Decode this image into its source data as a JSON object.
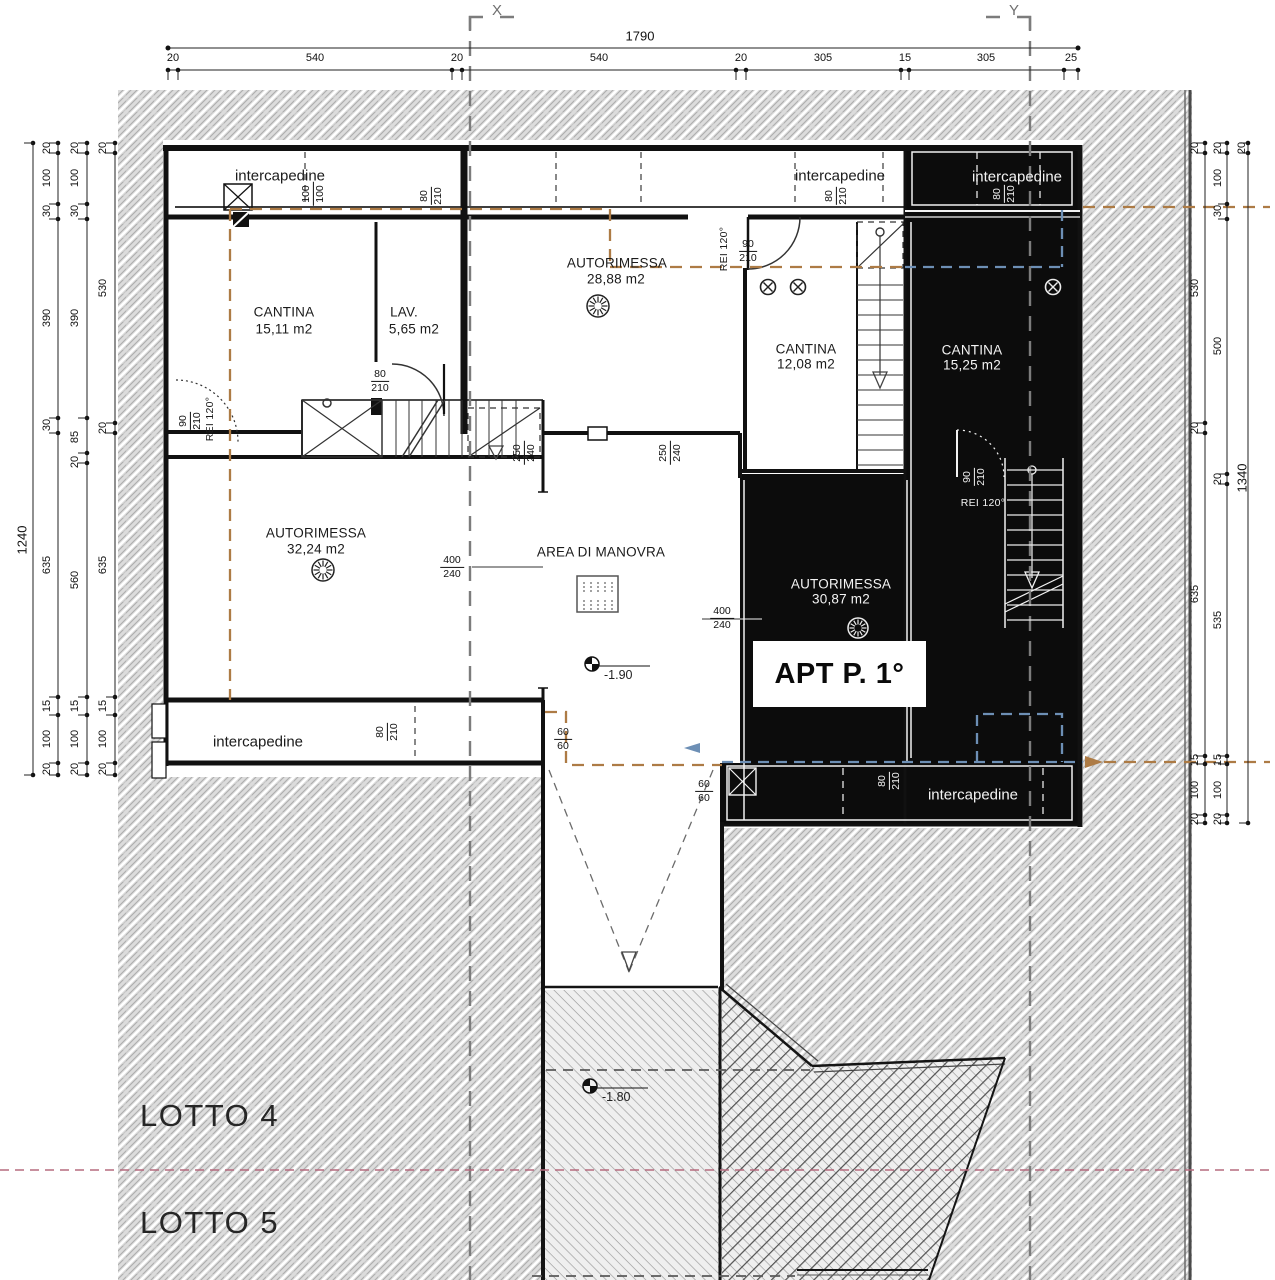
{
  "grid_markers": {
    "x": "X",
    "y": "Y"
  },
  "dimensions": {
    "top": {
      "total": "1790",
      "segments": [
        "20",
        "540",
        "20",
        "540",
        "20",
        "305",
        "15",
        "305",
        "25"
      ]
    },
    "left": {
      "total": "1240",
      "chain_a": [
        "20",
        "100",
        "30",
        "390",
        "30",
        "635",
        "15",
        "100",
        "20"
      ],
      "chain_b": [
        "20",
        "100",
        "30",
        "390",
        "85",
        "20",
        "560",
        "15",
        "100",
        "20"
      ],
      "chain_c": [
        "20",
        "530",
        "20",
        "635",
        "15",
        "100",
        "20"
      ]
    },
    "right": {
      "chain_a": [
        "20",
        "530",
        "20",
        "635",
        "15",
        "100",
        "20"
      ],
      "chain_b": [
        "20",
        "100",
        "30",
        "500",
        "20",
        "535",
        "15",
        "100",
        "20"
      ],
      "chain_c": [
        "20",
        "1340"
      ]
    }
  },
  "rooms": {
    "cantina_tl": {
      "name": "CANTINA",
      "area": "15,11 m2"
    },
    "lav": {
      "name": "LAV.",
      "area": "5,65 m2"
    },
    "autorimessa_top": {
      "name": "AUTORIMESSA",
      "area": "28,88 m2"
    },
    "cantina_center": {
      "name": "CANTINA",
      "area": "12,08 m2"
    },
    "cantina_right": {
      "name": "CANTINA",
      "area": "15,25 m2"
    },
    "autorimessa_left": {
      "name": "AUTORIMESSA",
      "area": "32,24 m2"
    },
    "area_manovra": {
      "name": "AREA DI MANOVRA"
    },
    "autorimessa_right": {
      "name": "AUTORIMESSA",
      "area": "30,87 m2"
    }
  },
  "annotations": {
    "intercapedine": "intercapedine",
    "apt_label": "APT P. 1°",
    "rei_label": "REI 120°",
    "lotto4": "LOTTO 4",
    "lotto5": "LOTTO 5",
    "level_manovra": "-1.90",
    "level_ramp": "-1.80"
  },
  "door_sizes": {
    "opening_100": {
      "top": "100",
      "bottom": "100"
    },
    "door_80": {
      "top": "80",
      "bottom": "210"
    },
    "door_90": {
      "top": "90",
      "bottom": "210"
    },
    "passage_250": {
      "top": "250",
      "bottom": "240"
    },
    "garage_400": {
      "top": "400",
      "bottom": "240"
    },
    "drain_60": {
      "top": "60",
      "bottom": "60"
    }
  },
  "colors": {
    "overhang_dashed": "#ad7b45",
    "apartment_dashed": "#6d8fb5",
    "lot_boundary": "#b56b7f",
    "grid_line": "#7c7c7c",
    "fill_black": "#0c0c0c"
  }
}
